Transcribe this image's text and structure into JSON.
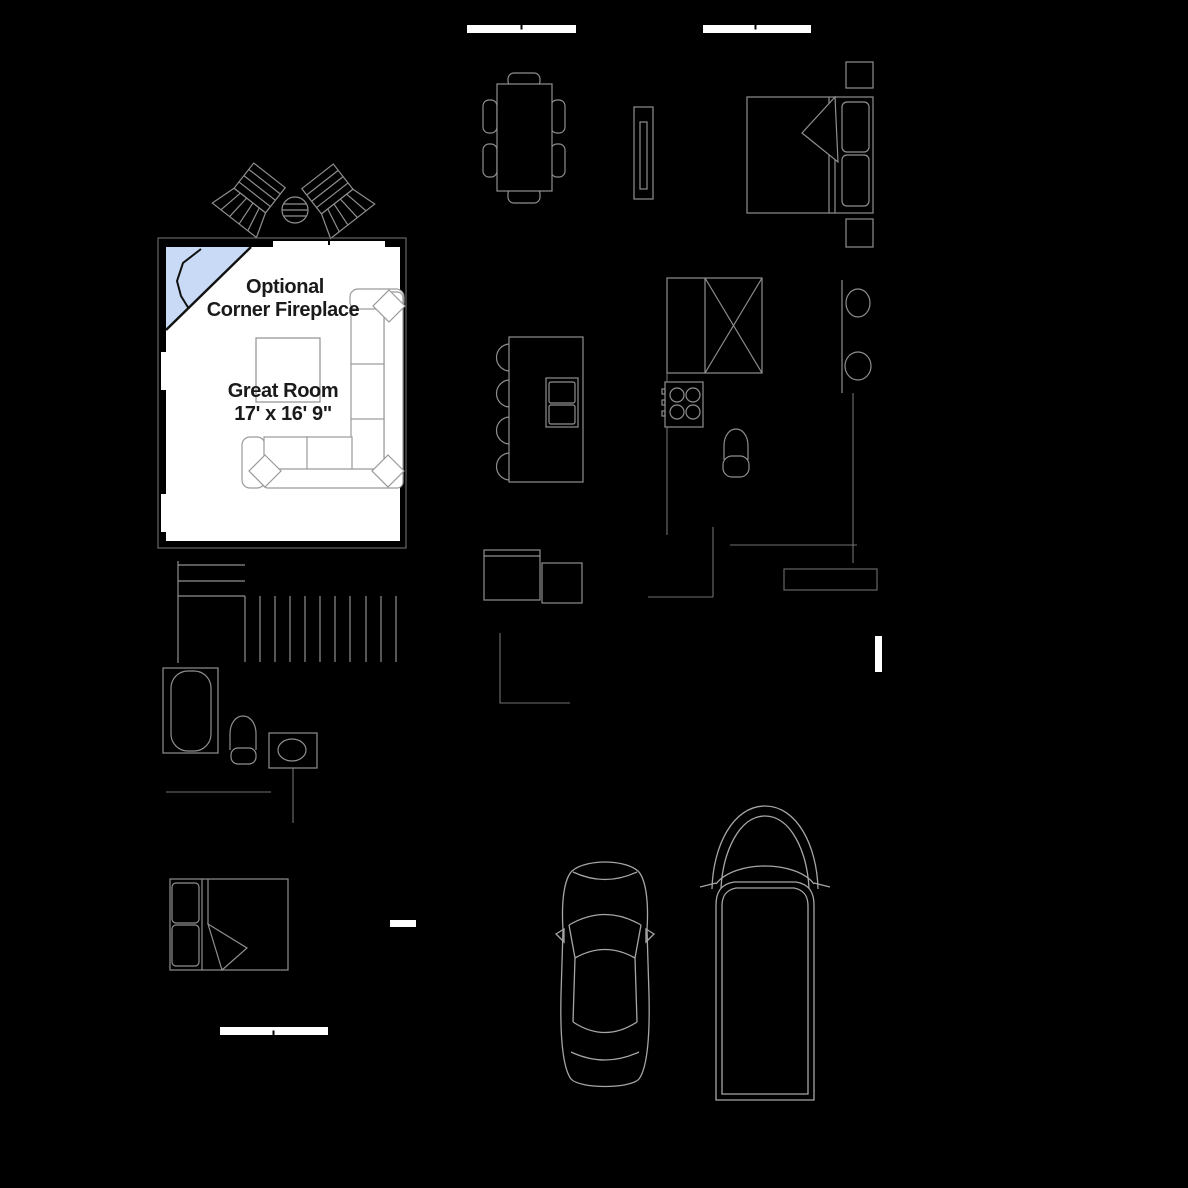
{
  "great_room": {
    "fireplace_note_line1": "Optional",
    "fireplace_note_line2": "Corner Fireplace",
    "room_name": "Great Room",
    "room_dimensions": "17' x 16' 9\""
  },
  "colors": {
    "background": "#000000",
    "room_fill": "#ffffff",
    "fireplace_fill": "#c8daf5",
    "outline_dark": "#111111",
    "furniture_line": "#8f8f8f",
    "sofa_line": "#9a9a9a",
    "vehicle_line": "#a6a6a6",
    "hairline": "#6f6f6f",
    "window_fill": "#ffffff",
    "text": "#1a1a1a"
  }
}
